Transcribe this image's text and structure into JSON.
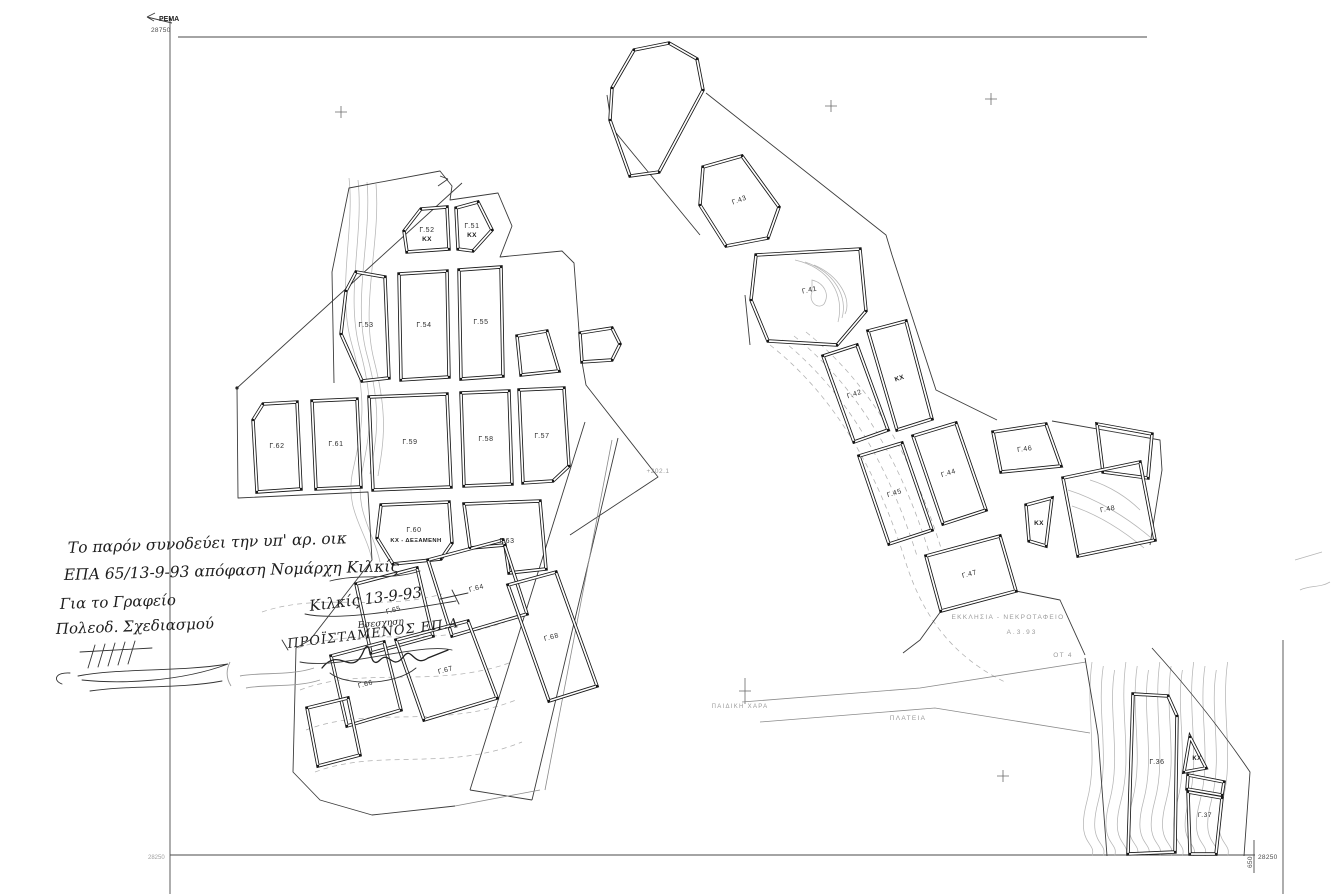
{
  "frame": {
    "top_left_arrow_label": "ΡΕΜΑ",
    "top_left_coord": "28750",
    "bottom_left_coord": "28250",
    "bottom_right_coord": "28250",
    "bottom_right_side_coord": "650"
  },
  "handwriting": {
    "line1": "Το παρόν συνοδεύει την υπ' αρ. οικ",
    "line2": "ΕΠΑ 65/13-9-93 απόφαση Νομάρχη Κιλκίς",
    "line3": "Για το Γραφείο",
    "line4": "Πολεοδ. Σχεδιασμού",
    "place_date": "Κιλκίς 13-9-93",
    "small_note": "Εσεσχηση",
    "title": "ΠΡΟΪΣΤΑΜΕΝΟΣ ΕΠ.Α"
  },
  "blocks": {
    "g51": {
      "label": "Γ.51",
      "zone": "ΚΧ"
    },
    "g52": {
      "label": "Γ.52",
      "zone": "ΚΧ"
    },
    "g53": {
      "label": "Γ.53"
    },
    "g54": {
      "label": "Γ.54"
    },
    "g55": {
      "label": "Γ.55"
    },
    "g57": {
      "label": "Γ.57"
    },
    "g58": {
      "label": "Γ.58"
    },
    "g59": {
      "label": "Γ.59"
    },
    "g60": {
      "label": "Γ.60",
      "zone": "ΚΧ - ΔΕΞΑΜΕΝΗ"
    },
    "g61": {
      "label": "Γ.61"
    },
    "g62": {
      "label": "Γ.62"
    },
    "g63": {
      "label": "Γ.63"
    },
    "g64": {
      "label": "Γ.64"
    },
    "g65": {
      "label": "Γ.65"
    },
    "g66": {
      "label": "Γ.66"
    },
    "g67": {
      "label": "Γ.67"
    },
    "g68": {
      "label": "Γ.68"
    },
    "g41": {
      "label": "Γ.41"
    },
    "g42": {
      "label": "Γ.42"
    },
    "g43": {
      "label": "Γ.43"
    },
    "g44": {
      "label": "Γ.44"
    },
    "g45": {
      "label": "Γ.45"
    },
    "g46": {
      "label": "Γ.46"
    },
    "g47": {
      "label": "Γ.47"
    },
    "g48": {
      "label": "Γ.48"
    },
    "g36": {
      "label": "Γ.36"
    },
    "g37": {
      "label": "Γ.37"
    },
    "kx_strip": {
      "zone": "ΚΧ"
    },
    "kx_mid": {
      "zone": "ΚΧ"
    },
    "kx_low": {
      "zone": "ΚΧ"
    }
  },
  "annotations": {
    "church": "ΕΚΚΛΗΣΙΑ - ΝΕΚΡΟΤΑΦΕΙΟ",
    "church_date": "Α.3.93",
    "square": "ΠΛΑΤΕΙΑ",
    "playground": "ΠΑΙΔΙΚΗ ΧΑΡΑ",
    "block_ref": "ΟΤ 4",
    "spot_elevation": "+202.1"
  }
}
